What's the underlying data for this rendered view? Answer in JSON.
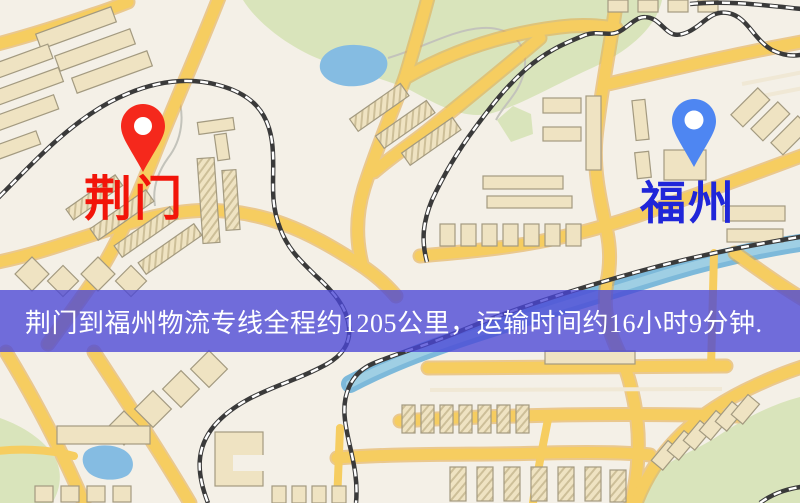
{
  "map": {
    "markers": [
      {
        "id": "origin",
        "label": "荆门",
        "pin_color": "#f5281c",
        "label_color": "#f2150a"
      },
      {
        "id": "destination",
        "label": "福州",
        "pin_color": "#4e86f2",
        "label_color": "#2026d9"
      }
    ],
    "banner": {
      "text": "荆门到福州物流专线全程约1205公里，运输时间约16小时9分钟.",
      "background": "#4a46d6",
      "text_color": "#ffffff"
    },
    "route": {
      "origin": "荆门",
      "destination": "福州",
      "service": "物流专线",
      "distance_km": 1205,
      "duration_hours": 16,
      "duration_minutes": 9
    },
    "palette": {
      "background": "#f4f0e7",
      "road": "#f6cd60",
      "road_casing": "#e2a947",
      "park": "#d9e4bb",
      "water": "#85bce2",
      "river": "#7db9da",
      "building": "#efe3c2",
      "railway": "#3a3a3a"
    }
  }
}
